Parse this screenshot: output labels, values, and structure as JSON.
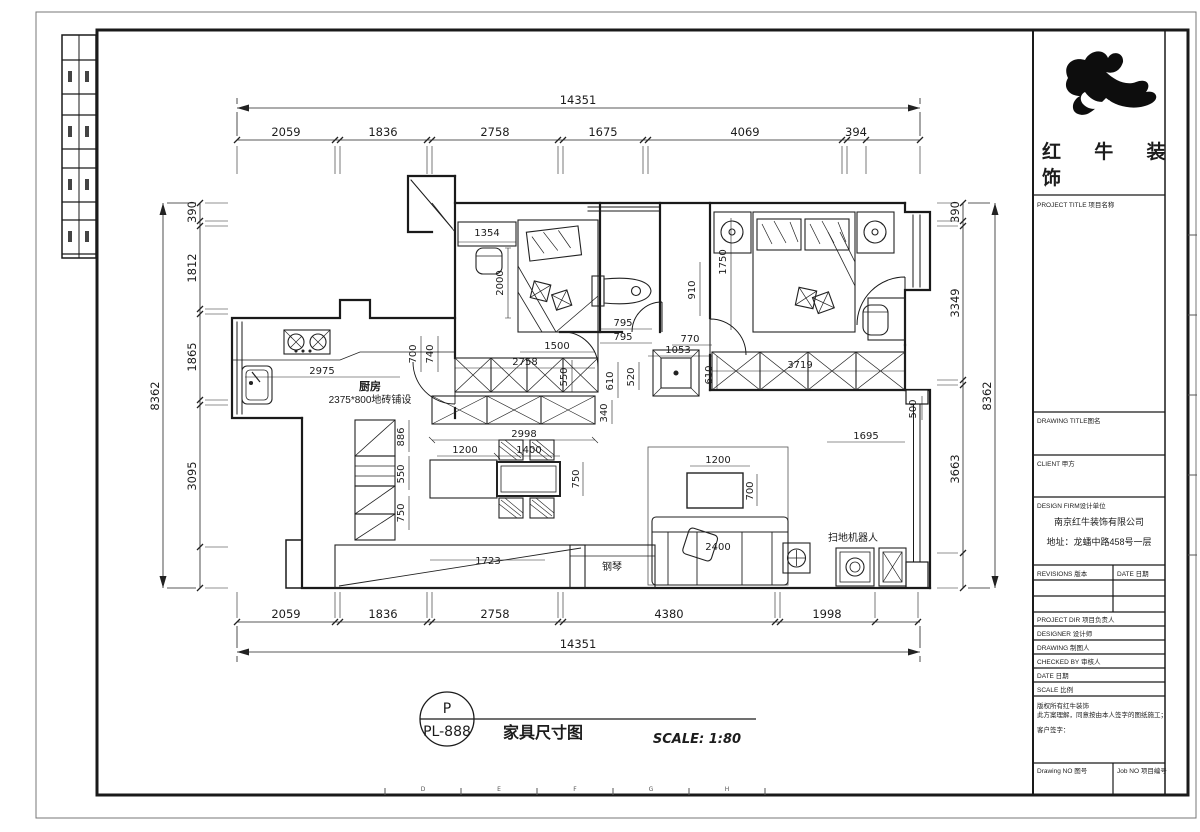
{
  "sheet": {
    "grid_letters": [
      "D",
      "E",
      "F",
      "G",
      "H"
    ]
  },
  "title_block": {
    "brand_line1": "红 牛 装",
    "brand_line2": "饰",
    "project_title_label": "PROJECT TITLE 项目名称",
    "drawing_title_label": "DRAWING TITLE图名",
    "client_label": "CLIENT 甲方",
    "design_firm_label": "DESIGN FIRM设计单位",
    "firm_name": "南京红牛装饰有限公司",
    "firm_address": "地址：龙蟠中路458号一层",
    "revisions_label": "REVISIONS 版本",
    "revisions_date_label": "DATE 日期",
    "project_dir_label": "PROJECT DIR  项目负责人",
    "designer_label": "DESIGNER  设计师",
    "drawing_person_label": "DRAWING  制图人",
    "checked_by_label": "CHECKED BY  审核人",
    "date_label": "DATE  日期",
    "scale_label": "SCALE  比例",
    "copyright_line1": "版权所有红牛装饰",
    "copyright_line2": "此方案理解，同意按由本人签字的图纸施工；",
    "customer_sign_label": "客户签字：",
    "drawing_no_label": "Drawing NO 图号",
    "job_no_label": "Job NO 项目编号"
  },
  "footer": {
    "badge_top": "P",
    "badge_code": "PL-888",
    "drawing_title": "家具尺寸图",
    "scale_text": "SCALE: 1:80"
  },
  "plan": {
    "labels": {
      "kitchen": "厨房",
      "kitchen_tile": "2375*800地砖铺设",
      "piano": "钢琴",
      "robot_vacuum": "扫地机器人"
    },
    "dims": {
      "top_overall": "14351",
      "bottom_overall": "14351",
      "left_overall": "8362",
      "right_overall": "8362",
      "top_segments": [
        "2059",
        "1836",
        "2758",
        "1675",
        "4069",
        "394"
      ],
      "bottom_segments": [
        "2059",
        "1836",
        "2758",
        "4380",
        "1998"
      ],
      "left_segments": [
        "390",
        "1812",
        "1865",
        "3095"
      ],
      "right_segments": [
        "390",
        "3349",
        "3663"
      ],
      "interior": {
        "d1354": "1354",
        "d2000": "2000",
        "d1500": "1500",
        "d2758": "2758",
        "d795a": "795",
        "d795b": "795",
        "d550a": "550",
        "d610a": "610",
        "d520": "520",
        "d340": "340",
        "d700a": "700",
        "d740": "740",
        "d2975": "2975",
        "d886": "886",
        "d550b": "550",
        "d750a": "750",
        "d1200a": "1200",
        "d1400": "1400",
        "d750b": "750",
        "d2998": "2998",
        "d1723": "1723",
        "d770": "770",
        "d1053": "1053",
        "d610b": "610",
        "d910": "910",
        "d1750": "1750",
        "d3719": "3719",
        "d1695": "1695",
        "d1200b": "1200",
        "d700b": "700",
        "d2400": "2400",
        "d500": "500"
      }
    }
  }
}
